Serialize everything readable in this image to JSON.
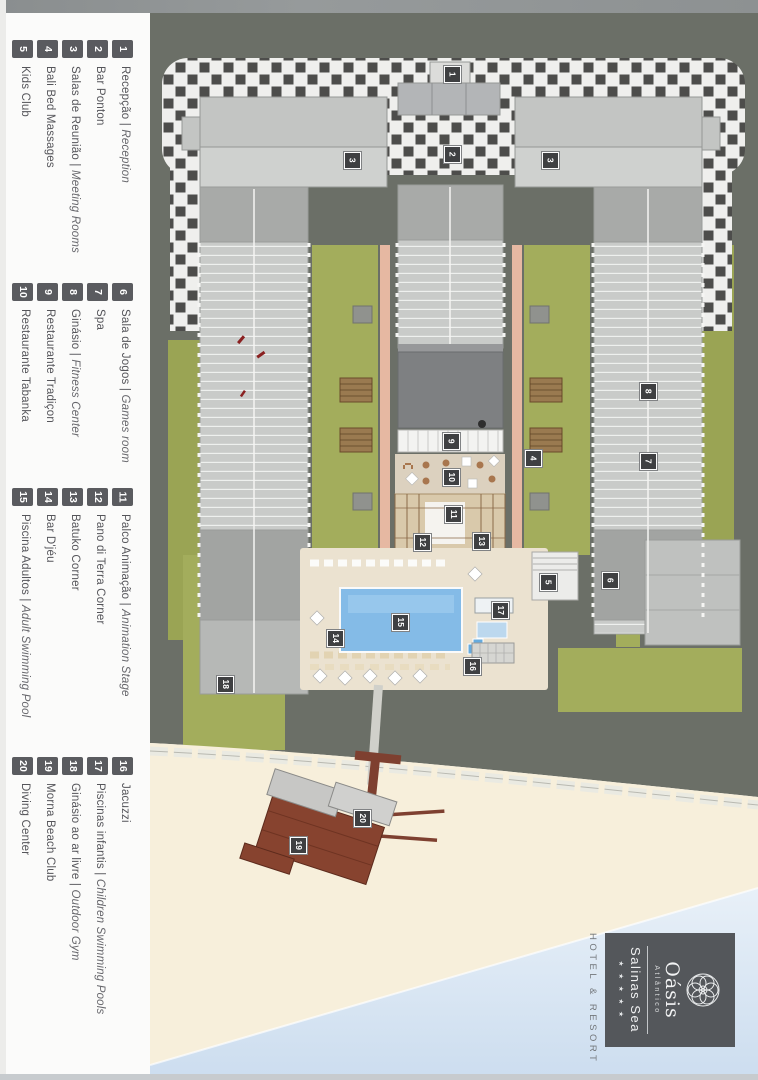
{
  "legend": {
    "separator": " | ",
    "groups": [
      {
        "items": [
          {
            "n": "1",
            "pt": "Recepção",
            "en": "Reception"
          },
          {
            "n": "2",
            "pt": "Bar Ponton"
          },
          {
            "n": "3",
            "pt": "Salas de Reunião",
            "en": "Meeting Rooms"
          },
          {
            "n": "4",
            "pt": "Bali Bed Massages"
          },
          {
            "n": "5",
            "pt": "Kids Club"
          }
        ]
      },
      {
        "items": [
          {
            "n": "6",
            "pt": "Sala de Jogos",
            "en": "Games room"
          },
          {
            "n": "7",
            "pt": "Spa"
          },
          {
            "n": "8",
            "pt": "Ginásio",
            "en": "Fitness Center"
          },
          {
            "n": "9",
            "pt": "Restaurante Tradiçon"
          },
          {
            "n": "10",
            "pt": "Restaurante Tabanka"
          }
        ]
      },
      {
        "items": [
          {
            "n": "11",
            "pt": "Palco Animação",
            "en": "Animation Stage"
          },
          {
            "n": "12",
            "pt": "Pano di Terra Corner"
          },
          {
            "n": "13",
            "pt": "Batuko Corner"
          },
          {
            "n": "14",
            "pt": "Bar D'jéu"
          },
          {
            "n": "15",
            "pt": "Piscina Adultos",
            "en": "Adult Swimming Pool"
          }
        ]
      },
      {
        "items": [
          {
            "n": "16",
            "pt": "Jacuzzi"
          },
          {
            "n": "17",
            "pt": "Piscinas infantis",
            "en": "Children Swimming Pools"
          },
          {
            "n": "18",
            "pt": "Ginásio ao ar livre",
            "en": "Outdoor Gym"
          },
          {
            "n": "19",
            "pt": "Morna Beach Club"
          },
          {
            "n": "20",
            "pt": "Diving Center"
          }
        ]
      }
    ]
  },
  "map": {
    "markers": [
      {
        "n": "1",
        "x": 452,
        "y": 74
      },
      {
        "n": "2",
        "x": 452,
        "y": 154
      },
      {
        "n": "3",
        "x": 352,
        "y": 160
      },
      {
        "n": "3",
        "x": 550,
        "y": 160
      },
      {
        "n": "4",
        "x": 533,
        "y": 458
      },
      {
        "n": "5",
        "x": 548,
        "y": 582
      },
      {
        "n": "6",
        "x": 610,
        "y": 580
      },
      {
        "n": "7",
        "x": 648,
        "y": 461
      },
      {
        "n": "8",
        "x": 648,
        "y": 391
      },
      {
        "n": "9",
        "x": 451,
        "y": 441
      },
      {
        "n": "10",
        "x": 451,
        "y": 477
      },
      {
        "n": "11",
        "x": 453,
        "y": 514
      },
      {
        "n": "12",
        "x": 422,
        "y": 542
      },
      {
        "n": "13",
        "x": 481,
        "y": 541
      },
      {
        "n": "14",
        "x": 335,
        "y": 638
      },
      {
        "n": "15",
        "x": 400,
        "y": 622
      },
      {
        "n": "16",
        "x": 472,
        "y": 666
      },
      {
        "n": "17",
        "x": 500,
        "y": 610
      },
      {
        "n": "18",
        "x": 225,
        "y": 684
      },
      {
        "n": "19",
        "x": 298,
        "y": 845
      },
      {
        "n": "20",
        "x": 362,
        "y": 818
      }
    ]
  },
  "logo": {
    "brand": "Oásis",
    "brand_sub": "Atlântico",
    "resort": "Salinas Sea",
    "stars": "★ ★ ★ ★ ★",
    "tagline": "HOTEL & RESORT"
  },
  "colors": {
    "road": "#6b6f67",
    "lawn": "#a3ad5c",
    "pool": "#84bbe7",
    "sand": "#f7efdb",
    "sea": "#d9e6f3",
    "pier_brown": "#7e4030",
    "marker_bg": "#3f4042",
    "legend_badge": "#5a5b5f",
    "logo_bg": "#54575b"
  }
}
